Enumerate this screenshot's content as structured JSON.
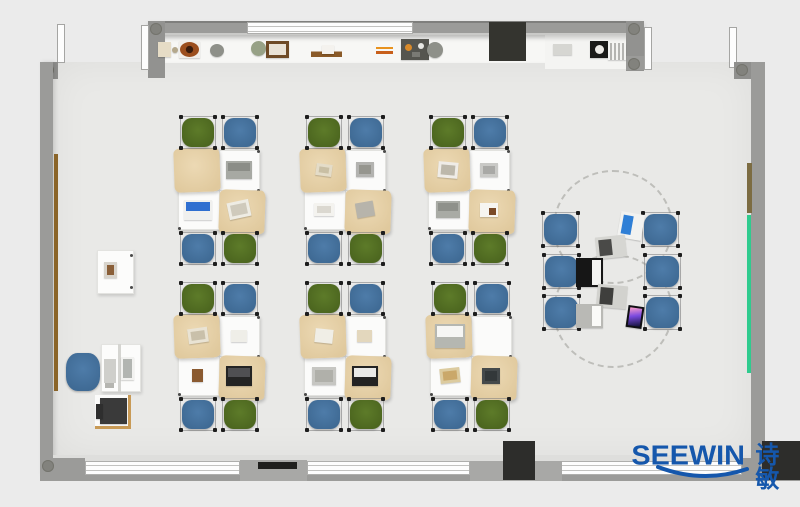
{
  "watermark": {
    "brand": "SEEWIN",
    "brand_cn": "诗敏",
    "color": "#1557ac"
  },
  "palette": {
    "background": "#ebebeb",
    "floor": "#e9e9e7",
    "counter": "#f7f7f5",
    "wall": "#9b9b99",
    "dark_box": "#2d2d2b",
    "tan_mat_light": "#ecd9b4",
    "tan_mat": "#e0c99d",
    "chair_green": "#5d7b29",
    "chair_green_dark": "#4c661f",
    "chair_blue": "#4e7ca9",
    "chair_blue_dark": "#3f6a94",
    "rail_green": "#2fcb8e",
    "rail_brown": "#8a6428",
    "logo_blue": "#1557ac"
  },
  "plan": {
    "architecture": [
      {
        "name": "floor",
        "x": 53,
        "y": 62,
        "w": 699,
        "h": 394,
        "color": "#e9e9e7",
        "cls": "floor"
      },
      {
        "name": "top-counter",
        "x": 163,
        "y": 35,
        "w": 465,
        "h": 28,
        "color": "#f7f7f5",
        "cls": "counter"
      },
      {
        "name": "top-recess",
        "x": 545,
        "y": 35,
        "w": 83,
        "h": 34,
        "color": "#f4f4f2"
      },
      {
        "name": "top-wall",
        "x": 148,
        "y": 21,
        "w": 496,
        "h": 14,
        "color": "#9b9b99",
        "cls": "wall-h"
      },
      {
        "name": "top-window",
        "x": 247,
        "y": 22,
        "w": 166,
        "h": 12,
        "cls": "window"
      },
      {
        "name": "top-wall-post-left",
        "x": 148,
        "y": 21,
        "w": 17,
        "h": 57,
        "color": "#929290",
        "pillar": true
      },
      {
        "name": "top-wall-post-right",
        "x": 626,
        "y": 21,
        "w": 18,
        "h": 50,
        "color": "#929290",
        "pillar": true
      },
      {
        "name": "post-foot-right",
        "x": 626,
        "y": 56,
        "w": 26,
        "h": 14,
        "color": "#9b9b99",
        "pillar": true
      },
      {
        "name": "door-frame-1",
        "x": 57,
        "y": 24,
        "w": 8,
        "h": 39,
        "cls": "doorframe"
      },
      {
        "name": "door-frame-2",
        "x": 141,
        "y": 25,
        "w": 8,
        "h": 45,
        "cls": "doorframe"
      },
      {
        "name": "door-frame-3",
        "x": 644,
        "y": 27,
        "w": 8,
        "h": 43,
        "cls": "doorframe"
      },
      {
        "name": "door-frame-4",
        "x": 729,
        "y": 27,
        "w": 8,
        "h": 41,
        "cls": "doorframe"
      },
      {
        "name": "corner-top-left",
        "x": 40,
        "y": 62,
        "w": 18,
        "h": 17,
        "color": "#8f8f8d",
        "pillar": true
      },
      {
        "name": "left-wall",
        "x": 40,
        "y": 62,
        "w": 13,
        "h": 412,
        "color": "#9b9b99",
        "cls": "wall-v"
      },
      {
        "name": "corner-top-right",
        "x": 734,
        "y": 62,
        "w": 31,
        "h": 17,
        "color": "#8f8f8d",
        "pillar": true
      },
      {
        "name": "right-wall",
        "x": 751,
        "y": 62,
        "w": 14,
        "h": 412,
        "color": "#9b9b99"
      },
      {
        "name": "bottom-sill",
        "x": 53,
        "y": 455,
        "w": 698,
        "h": 7,
        "color": "#dededc"
      },
      {
        "name": "bottom-wall-outer",
        "x": 40,
        "y": 474,
        "w": 760,
        "h": 7,
        "color": "#9b9b99"
      },
      {
        "name": "bottom-window-1",
        "x": 85,
        "y": 461,
        "w": 155,
        "h": 14,
        "cls": "window"
      },
      {
        "name": "bottom-window-2",
        "x": 307,
        "y": 461,
        "w": 163,
        "h": 14,
        "cls": "window"
      },
      {
        "name": "bottom-window-3",
        "x": 560,
        "y": 461,
        "w": 182,
        "h": 14,
        "cls": "window"
      },
      {
        "name": "bottom-block-left",
        "x": 40,
        "y": 458,
        "w": 45,
        "h": 23,
        "color": "#9b9b99",
        "pillar": true
      },
      {
        "name": "bottom-block-mid1",
        "x": 240,
        "y": 460,
        "w": 67,
        "h": 21,
        "color": "#a8a8a6"
      },
      {
        "name": "bottom-block-mid2",
        "x": 470,
        "y": 461,
        "w": 92,
        "h": 20,
        "color": "#a8a8a6"
      },
      {
        "name": "bottom-block-right",
        "x": 742,
        "y": 458,
        "w": 23,
        "h": 23,
        "color": "#9b9b99"
      },
      {
        "name": "wall-cabinet",
        "x": 489,
        "y": 22,
        "w": 37,
        "h": 39,
        "color": "#34342f"
      },
      {
        "name": "bottom-speaker",
        "x": 503,
        "y": 441,
        "w": 32,
        "h": 39,
        "color": "#2d2d2b"
      },
      {
        "name": "bottom-right-box",
        "x": 762,
        "y": 441,
        "w": 38,
        "h": 39,
        "color": "#2d2d2b"
      },
      {
        "name": "bottom-black-strip",
        "x": 258,
        "y": 462,
        "w": 39,
        "h": 7,
        "color": "#1f1f1d"
      },
      {
        "name": "left-rail-brown",
        "x": 54,
        "y": 154,
        "w": 4,
        "h": 237,
        "color": "#8a6428"
      },
      {
        "name": "right-rail-brown",
        "x": 747,
        "y": 163,
        "w": 5,
        "h": 50,
        "color": "#7c6c42"
      },
      {
        "name": "right-rail-green",
        "x": 747,
        "y": 215,
        "w": 4,
        "h": 158,
        "color": "#2fcb8e"
      }
    ],
    "shelf_items": [
      {
        "name": "tan-box",
        "x": 158,
        "y": 42,
        "w": 13,
        "h": 15,
        "kind": "box",
        "c1": "#e6dcc6"
      },
      {
        "name": "small-ball",
        "x": 172,
        "y": 47,
        "w": 6,
        "h": 6,
        "kind": "circle",
        "c1": "#b4a88c"
      },
      {
        "name": "bowl",
        "x": 179,
        "y": 41,
        "w": 21,
        "h": 17,
        "kind": "bowl",
        "c1": "#9c4f1e"
      },
      {
        "name": "planter-pot",
        "x": 210,
        "y": 44,
        "w": 14,
        "h": 13,
        "kind": "circle",
        "c1": "#8e9089"
      },
      {
        "name": "plant",
        "x": 251,
        "y": 41,
        "w": 15,
        "h": 15,
        "kind": "circle",
        "c1": "#97a186"
      },
      {
        "name": "photo-frame",
        "x": 266,
        "y": 41,
        "w": 23,
        "h": 17,
        "kind": "frame",
        "c1": "#6e4a26",
        "c2": "#e9e2d6"
      },
      {
        "name": "wood-tray",
        "x": 311,
        "y": 45,
        "w": 31,
        "h": 12,
        "kind": "plank",
        "c1": "#8a5a28",
        "c2": "#f4f2ee"
      },
      {
        "name": "pencils",
        "x": 376,
        "y": 47,
        "w": 17,
        "h": 7,
        "kind": "pencils",
        "c1": "#e8921e",
        "c2": "#c85f1a"
      },
      {
        "name": "desk-organizer",
        "x": 401,
        "y": 39,
        "w": 28,
        "h": 21,
        "kind": "tray",
        "c1": "#55554f"
      },
      {
        "name": "planter-pot-2",
        "x": 427,
        "y": 42,
        "w": 16,
        "h": 16,
        "kind": "circle",
        "c1": "#8e9089"
      },
      {
        "name": "counter-box",
        "x": 553,
        "y": 44,
        "w": 19,
        "h": 11,
        "kind": "box",
        "c1": "#d6d6d2"
      },
      {
        "name": "coffee-machine",
        "x": 590,
        "y": 41,
        "w": 18,
        "h": 17,
        "kind": "machine",
        "c1": "#1a1a18",
        "c2": "#eceae6"
      },
      {
        "name": "vent-grille",
        "x": 608,
        "y": 43,
        "w": 18,
        "h": 17,
        "kind": "grille",
        "c1": "#b4b4b1"
      }
    ],
    "clusters": [
      {
        "id": "A1",
        "x": 178,
        "y": 150,
        "items": [
          {
            "name": "laptop",
            "x": 226,
            "y": 161,
            "w": 26,
            "h": 18,
            "kind": "laptop",
            "c1": "#a7a9a3",
            "c2": "#8b8d87"
          },
          {
            "name": "laptop-blue-screen",
            "x": 184,
            "y": 200,
            "w": 28,
            "h": 20,
            "kind": "laptop",
            "c1": "#f0f0ee",
            "c2": "#2f6fd0"
          },
          {
            "name": "book",
            "x": 228,
            "y": 201,
            "w": 22,
            "h": 17,
            "kind": "book",
            "c1": "#eeece4",
            "c2": "#cfcabc",
            "rot": -12
          }
        ]
      },
      {
        "id": "B1",
        "x": 304,
        "y": 150,
        "items": [
          {
            "name": "book",
            "x": 316,
            "y": 164,
            "w": 16,
            "h": 12,
            "kind": "book",
            "c1": "#e4dcc8",
            "c2": "#c9bfa4",
            "rot": 8
          },
          {
            "name": "tablet",
            "x": 356,
            "y": 162,
            "w": 18,
            "h": 15,
            "kind": "tablet",
            "c1": "#b3b3b0",
            "c2": "#96968f"
          },
          {
            "name": "book",
            "x": 314,
            "y": 203,
            "w": 20,
            "h": 13,
            "kind": "book",
            "c1": "#f4f3ef",
            "c2": "#dbd8d0"
          },
          {
            "name": "cloth",
            "x": 356,
            "y": 202,
            "w": 18,
            "h": 15,
            "kind": "pad",
            "c1": "#b7b4ab",
            "rot": -10
          }
        ]
      },
      {
        "id": "C1",
        "x": 428,
        "y": 150,
        "items": [
          {
            "name": "open-book",
            "x": 438,
            "y": 162,
            "w": 20,
            "h": 16,
            "kind": "book",
            "c1": "#efece7",
            "c2": "#bdb8ab",
            "rot": 5
          },
          {
            "name": "book",
            "x": 480,
            "y": 163,
            "w": 18,
            "h": 14,
            "kind": "book",
            "c1": "#c9c9c6",
            "c2": "#a9a9a6"
          },
          {
            "name": "laptop",
            "x": 436,
            "y": 201,
            "w": 24,
            "h": 17,
            "kind": "laptop",
            "c1": "#a9aba5",
            "c2": "#8f918b"
          },
          {
            "name": "paper",
            "x": 480,
            "y": 203,
            "w": 18,
            "h": 14,
            "kind": "paper-chip",
            "c1": "#f6f5f1",
            "c2": "#7a4a28"
          }
        ]
      },
      {
        "id": "A2",
        "x": 178,
        "y": 316,
        "items": [
          {
            "name": "book",
            "x": 188,
            "y": 328,
            "w": 20,
            "h": 15,
            "kind": "book",
            "c1": "#e9e3d4",
            "c2": "#c9c0aa",
            "rot": -8
          },
          {
            "name": "paper",
            "x": 231,
            "y": 330,
            "w": 16,
            "h": 12,
            "kind": "pad",
            "c1": "#efeee8"
          },
          {
            "name": "wood-block",
            "x": 192,
            "y": 369,
            "w": 11,
            "h": 13,
            "kind": "pad",
            "c1": "#8a5a30"
          },
          {
            "name": "laptop-black",
            "x": 226,
            "y": 366,
            "w": 26,
            "h": 20,
            "kind": "laptop",
            "c1": "#242424",
            "c2": "#4f4f52"
          }
        ]
      },
      {
        "id": "B2",
        "x": 304,
        "y": 316,
        "items": [
          {
            "name": "paper",
            "x": 315,
            "y": 329,
            "w": 18,
            "h": 14,
            "kind": "pad",
            "c1": "#f0eee6",
            "rot": 6
          },
          {
            "name": "paper-tan",
            "x": 357,
            "y": 330,
            "w": 15,
            "h": 12,
            "kind": "pad",
            "c1": "#e3d7bd"
          },
          {
            "name": "gray-pad",
            "x": 312,
            "y": 367,
            "w": 24,
            "h": 18,
            "kind": "pad",
            "c1": "#c6c6c2",
            "c2": "#b0b0aa"
          },
          {
            "name": "laptop-black",
            "x": 352,
            "y": 366,
            "w": 26,
            "h": 20,
            "kind": "laptop",
            "c1": "#232323",
            "c2": "#e9e9e7"
          }
        ]
      },
      {
        "id": "C2",
        "x": 430,
        "y": 316,
        "items": [
          {
            "name": "laptop-open",
            "x": 435,
            "y": 324,
            "w": 30,
            "h": 24,
            "kind": "laptop",
            "c1": "#b5b7b1",
            "c2": "#f6f6f4"
          },
          {
            "name": "notebook",
            "x": 440,
            "y": 368,
            "w": 20,
            "h": 15,
            "kind": "book",
            "c1": "#dccb9f",
            "c2": "#caa86a",
            "rot": -6
          },
          {
            "name": "tablet-dark",
            "x": 482,
            "y": 368,
            "w": 18,
            "h": 16,
            "kind": "tablet",
            "c1": "#44494b",
            "c2": "#33383a"
          }
        ]
      }
    ],
    "discussion": {
      "circles": [
        {
          "x": 553,
          "y": 170,
          "w": 120,
          "h": 114
        },
        {
          "x": 553,
          "y": 254,
          "w": 120,
          "h": 114
        }
      ],
      "chairs": [
        {
          "x": 542,
          "y": 212
        },
        {
          "x": 543,
          "y": 254
        },
        {
          "x": 543,
          "y": 295
        },
        {
          "x": 642,
          "y": 212
        },
        {
          "x": 644,
          "y": 254
        },
        {
          "x": 644,
          "y": 295
        }
      ],
      "items": [
        {
          "name": "tablet-stand",
          "x": 619,
          "y": 213,
          "w": 24,
          "h": 26,
          "kind": "deskpad",
          "c1": "#f2f2f0",
          "c2": "#2f7fd6",
          "rot": 10
        },
        {
          "name": "device-pad",
          "x": 596,
          "y": 236,
          "w": 30,
          "h": 22,
          "kind": "deskpad",
          "c1": "#d6d6d2",
          "c2": "#4a4a48",
          "rot": -6
        },
        {
          "name": "black-laptop",
          "x": 576,
          "y": 258,
          "w": 27,
          "h": 29,
          "kind": "laptop-side",
          "c1": "#161616",
          "c2": "#f3f3f1"
        },
        {
          "name": "device-pad",
          "x": 597,
          "y": 285,
          "w": 30,
          "h": 23,
          "kind": "deskpad",
          "c1": "#d2d2ce",
          "c2": "#3f3f3d",
          "rot": 5
        },
        {
          "name": "white-laptop",
          "x": 576,
          "y": 304,
          "w": 27,
          "h": 24,
          "kind": "laptop-side",
          "c1": "#b9b9b5",
          "c2": "#fafaf8"
        },
        {
          "name": "phone",
          "x": 627,
          "y": 306,
          "w": 16,
          "h": 22,
          "kind": "phone",
          "c1": "#101014",
          "c2": "#c85f9e",
          "rot": 8
        }
      ]
    },
    "teacher": {
      "demo_desk": {
        "x": 97,
        "y": 250,
        "w": 37,
        "h": 44
      },
      "picture": {
        "x": 104,
        "y": 262,
        "w": 13,
        "h": 16,
        "c1": "#d8d4cc",
        "c2": "#8a5f38"
      },
      "chair": {
        "x": 63,
        "y": 350,
        "w": 40,
        "h": 44
      },
      "desk": {
        "x": 101,
        "y": 344,
        "w": 40,
        "h": 48
      },
      "divider": {
        "x": 118,
        "y": 344,
        "w": 3,
        "h": 48
      },
      "sidepad": {
        "x": 104,
        "y": 359,
        "w": 12,
        "h": 24
      },
      "monitor": {
        "x": 121,
        "y": 357,
        "w": 13,
        "h": 23
      },
      "keyboard": {
        "x": 105,
        "y": 383,
        "w": 9,
        "h": 5
      },
      "printer_stand": {
        "x": 95,
        "y": 395,
        "w": 36,
        "h": 34
      },
      "printer": {
        "x": 100,
        "y": 398,
        "w": 27,
        "h": 26
      },
      "printer_side": {
        "x": 96,
        "y": 404,
        "w": 7,
        "h": 15
      }
    }
  }
}
